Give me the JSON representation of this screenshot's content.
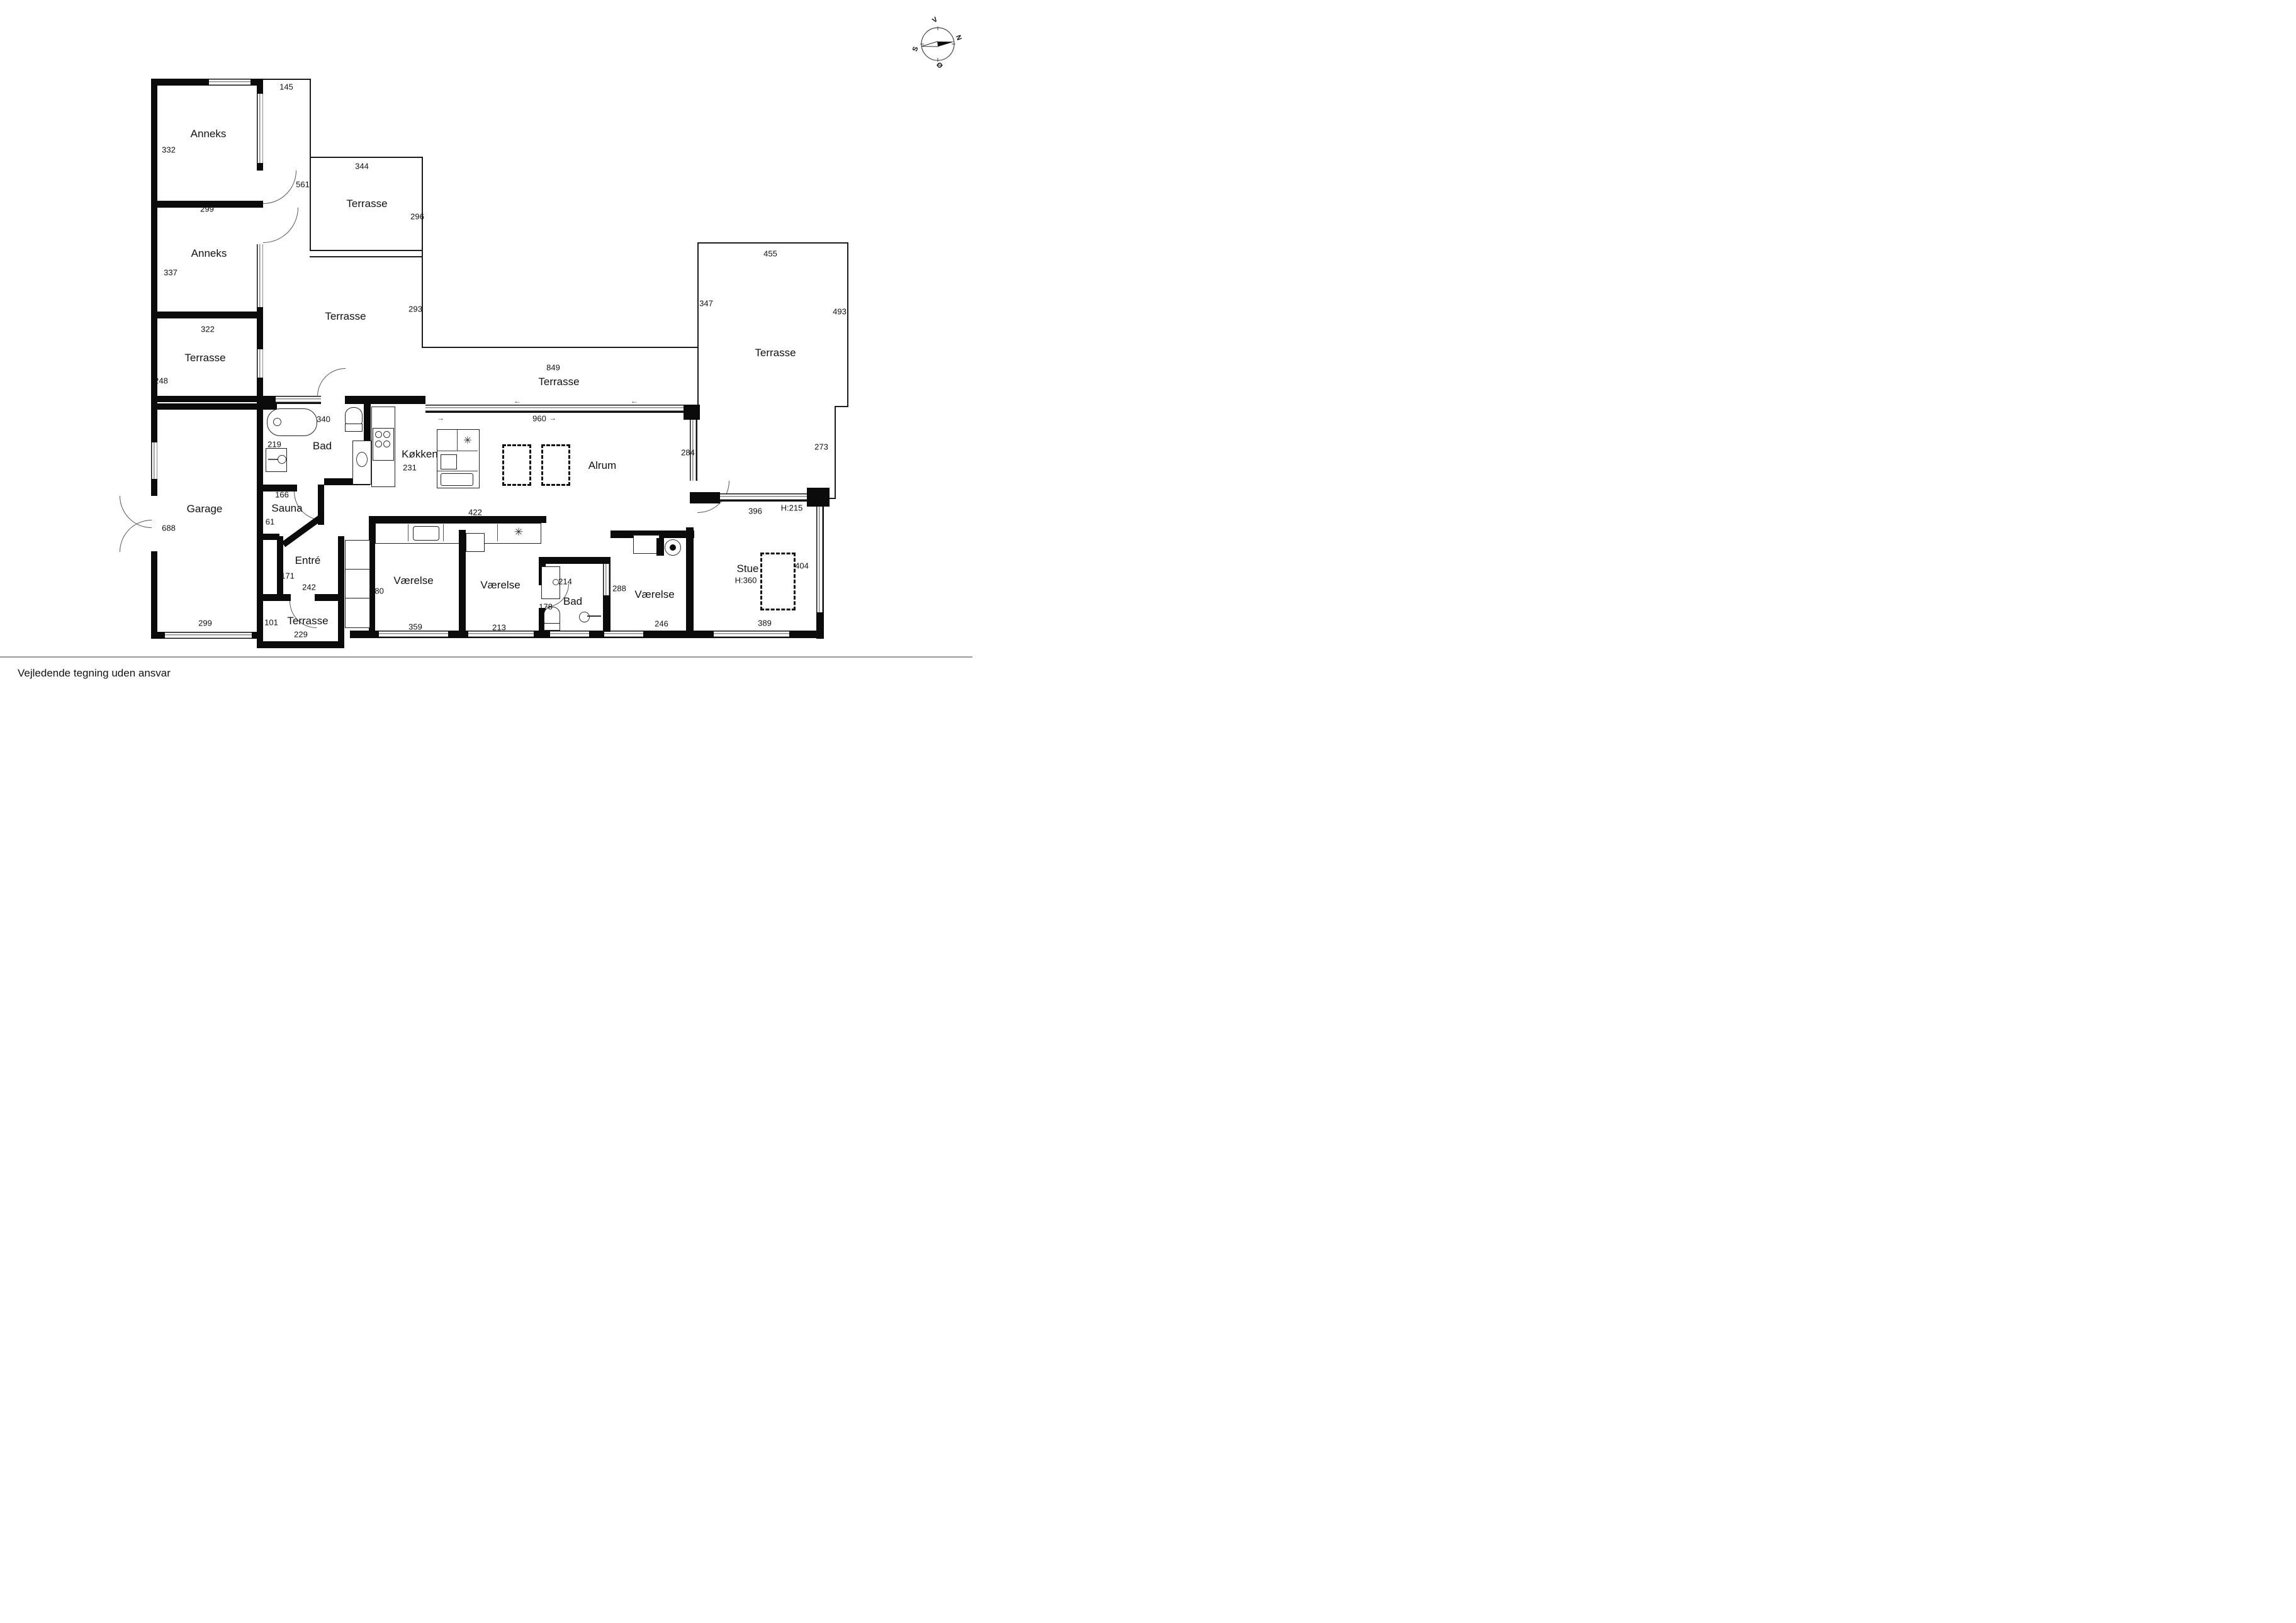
{
  "disclaimer": "Vejledende tegning uden ansvar",
  "compass": {
    "north": "N",
    "south": "S",
    "west": "V",
    "east": "Ø"
  },
  "icons": {
    "arrow_left": "←",
    "arrow_right": "→",
    "freezer": "✳"
  },
  "labels": {
    "d145": "145",
    "anneks1": "Anneks",
    "d332": "332",
    "d299a": "299",
    "anneks2": "Anneks",
    "d337": "337",
    "d561": "561",
    "d344": "344",
    "terr_nw": "Terrasse",
    "d296": "296",
    "d322": "322",
    "terr_w": "Terrasse",
    "d248": "248",
    "terr_mid": "Terrasse",
    "d293": "293",
    "d455": "455",
    "d347": "347",
    "d493": "493",
    "terr_e": "Terrasse",
    "d273": "273",
    "d284": "284",
    "d849": "849",
    "terr_s": "Terrasse",
    "d960": "960",
    "d340": "340",
    "bad_w": "Bad",
    "d219": "219",
    "koekken": "Køkken",
    "d231": "231",
    "alrum": "Alrum",
    "d166": "166",
    "sauna": "Sauna",
    "d61": "61",
    "d422": "422",
    "garage": "Garage",
    "d688": "688",
    "d299g": "299",
    "entre": "Entré",
    "d171": "171",
    "d242": "242",
    "d280": "280",
    "d101": "101",
    "terr_entry": "Terrasse",
    "d229": "229",
    "vaer1": "Værelse",
    "d359": "359",
    "vaer2": "Værelse",
    "d213": "213",
    "d214": "214",
    "bad_e": "Bad",
    "d178": "178",
    "d288": "288",
    "vaer3": "Værelse",
    "d246": "246",
    "stue": "Stue",
    "stue_h": "H:360",
    "d389": "389",
    "d404": "404",
    "d396": "396",
    "h215": "H:215"
  }
}
